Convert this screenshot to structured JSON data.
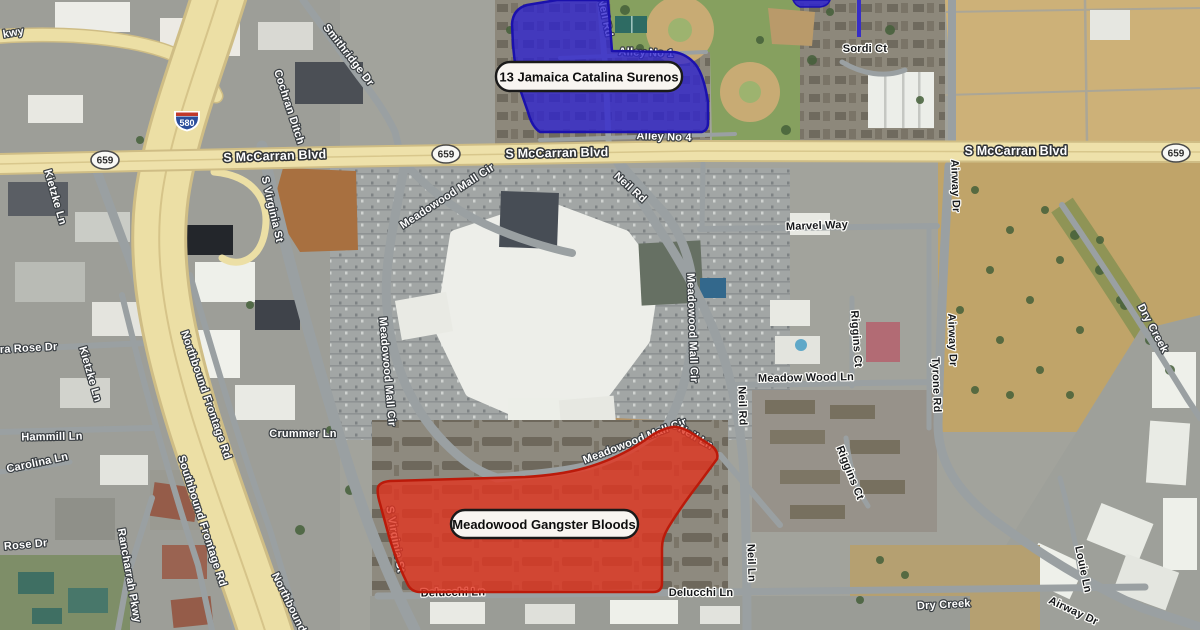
{
  "territories": {
    "surenos": {
      "label": "13 Jamaica Catalina Surenos",
      "fill": "#2e23cf",
      "stroke": "#1b11ad"
    },
    "bloods": {
      "label": "Meadowood Gangster Bloods",
      "fill": "#e23420",
      "stroke": "#bb1a0a"
    }
  },
  "shields": {
    "interstate_580": "580",
    "route_659": "659"
  },
  "colors": {
    "road_yellow": "#eee1aa",
    "freeway_yellow": "#ecdfa5",
    "callout_bg": "#f8f5f1",
    "callout_border": "#1a1a1a"
  },
  "street_labels": [
    {
      "text": "kwy",
      "x": 14,
      "y": 36,
      "rot": -10,
      "style": "minor-light"
    },
    {
      "text": "S McCarran Blvd",
      "x": 275,
      "y": 160,
      "rot": -2,
      "style": "major"
    },
    {
      "text": "S McCarran Blvd",
      "x": 557,
      "y": 157,
      "rot": -1,
      "style": "major"
    },
    {
      "text": "S McCarran Blvd",
      "x": 1016,
      "y": 155,
      "rot": 0,
      "style": "major"
    },
    {
      "text": "Smithridge Dr",
      "x": 346,
      "y": 57,
      "rot": 52,
      "style": "minor-light"
    },
    {
      "text": "Cochran Ditch",
      "x": 286,
      "y": 108,
      "rot": 72,
      "style": "minor-light"
    },
    {
      "text": "S Virginia St",
      "x": 269,
      "y": 210,
      "rot": 77,
      "style": "minor-light"
    },
    {
      "text": "S Virginia St",
      "x": 392,
      "y": 540,
      "rot": 80,
      "style": "minor-light"
    },
    {
      "text": "Meadowood Mall Cir",
      "x": 449,
      "y": 199,
      "rot": -33,
      "style": "minor-light"
    },
    {
      "text": "Meadowood Mall Cir",
      "x": 384,
      "y": 372,
      "rot": 85,
      "style": "minor-light"
    },
    {
      "text": "Meadowood Mall Cir",
      "x": 689,
      "y": 328,
      "rot": 88,
      "style": "minor-light"
    },
    {
      "text": "Meadowood Mall Cir",
      "x": 636,
      "y": 444,
      "rot": -21,
      "style": "minor-light"
    },
    {
      "text": "Neil Rd",
      "x": 602,
      "y": 18,
      "rot": 78,
      "style": "minor-light"
    },
    {
      "text": "Neil Rd",
      "x": 628,
      "y": 190,
      "rot": 42,
      "style": "minor-light"
    },
    {
      "text": "Neil Rd",
      "x": 739,
      "y": 406,
      "rot": 88,
      "style": "minor-dark"
    },
    {
      "text": "Neil Ln",
      "x": 694,
      "y": 440,
      "rot": 30,
      "style": "minor-light"
    },
    {
      "text": "Neil Ln",
      "x": 748,
      "y": 563,
      "rot": 88,
      "style": "minor-dark"
    },
    {
      "text": "Alley No 1",
      "x": 646,
      "y": 56,
      "rot": 2,
      "style": "minor-light"
    },
    {
      "text": "Alley No 4",
      "x": 664,
      "y": 140,
      "rot": 2,
      "style": "minor-light"
    },
    {
      "text": "Sordi Ct",
      "x": 865,
      "y": 52,
      "rot": 0,
      "style": "minor-dark"
    },
    {
      "text": "Marvel Way",
      "x": 817,
      "y": 229,
      "rot": -2,
      "style": "minor-dark"
    },
    {
      "text": "Riggins Ct",
      "x": 853,
      "y": 339,
      "rot": 86,
      "style": "minor-dark"
    },
    {
      "text": "Riggins Ct",
      "x": 847,
      "y": 474,
      "rot": 68,
      "style": "minor-dark"
    },
    {
      "text": "Meadow Wood Ln",
      "x": 806,
      "y": 381,
      "rot": -1,
      "style": "minor-dark"
    },
    {
      "text": "Tyrone Rd",
      "x": 933,
      "y": 385,
      "rot": 88,
      "style": "minor-dark"
    },
    {
      "text": "Airway Dr",
      "x": 952,
      "y": 186,
      "rot": 88,
      "style": "minor-dark"
    },
    {
      "text": "Airway Dr",
      "x": 949,
      "y": 340,
      "rot": 88,
      "style": "minor-dark"
    },
    {
      "text": "Airway Dr",
      "x": 1072,
      "y": 614,
      "rot": 25,
      "style": "minor-dark"
    },
    {
      "text": "Louie Ln",
      "x": 1080,
      "y": 570,
      "rot": 78,
      "style": "minor-dark"
    },
    {
      "text": "Dry Creek",
      "x": 1150,
      "y": 330,
      "rot": 62,
      "style": "minor-light"
    },
    {
      "text": "Dry Creek",
      "x": 944,
      "y": 608,
      "rot": -3,
      "style": "minor-light"
    },
    {
      "text": "Delucchi Ln",
      "x": 453,
      "y": 596,
      "rot": -1,
      "style": "minor-dark"
    },
    {
      "text": "Delucchi Ln",
      "x": 701,
      "y": 596,
      "rot": 0,
      "style": "minor-dark"
    },
    {
      "text": "Kietzke Ln",
      "x": 52,
      "y": 198,
      "rot": 74,
      "style": "minor-light"
    },
    {
      "text": "Kietzke Ln",
      "x": 87,
      "y": 375,
      "rot": 74,
      "style": "minor-light"
    },
    {
      "text": "Sierra Rose Dr",
      "x": 18,
      "y": 352,
      "rot": -3,
      "style": "minor-light"
    },
    {
      "text": "Hammill Ln",
      "x": 52,
      "y": 440,
      "rot": -1,
      "style": "minor-light"
    },
    {
      "text": "Carolina Ln",
      "x": 38,
      "y": 466,
      "rot": -12,
      "style": "minor-light"
    },
    {
      "text": "Rancharrah Pkwy",
      "x": 126,
      "y": 576,
      "rot": 80,
      "style": "minor-light"
    },
    {
      "text": "Northbound Frontage Rd",
      "x": 203,
      "y": 396,
      "rot": 71,
      "style": "minor-light"
    },
    {
      "text": "Southbound Frontage Rd",
      "x": 199,
      "y": 522,
      "rot": 72,
      "style": "minor-light"
    },
    {
      "text": "Northbound",
      "x": 286,
      "y": 604,
      "rot": 64,
      "style": "minor-light"
    },
    {
      "text": "Crummer Ln",
      "x": 303,
      "y": 437,
      "rot": 0,
      "style": "minor-light"
    },
    {
      "text": "Rose Dr",
      "x": 26,
      "y": 548,
      "rot": -5,
      "style": "minor-light"
    }
  ]
}
